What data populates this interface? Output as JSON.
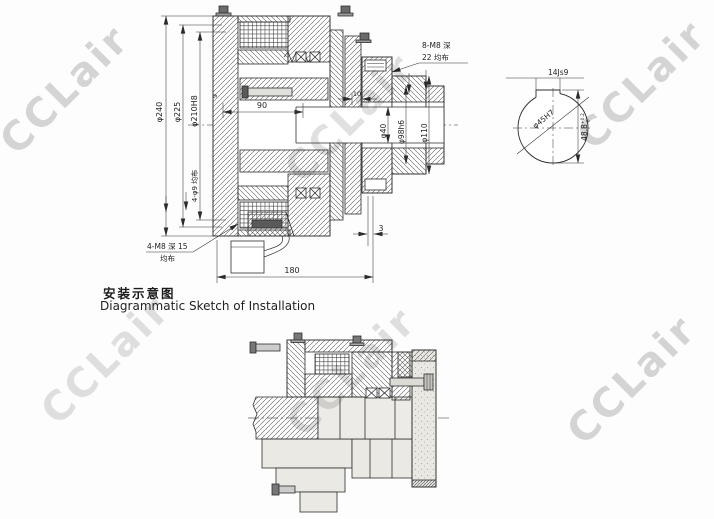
{
  "watermark": {
    "text": "CCLair"
  },
  "titles": {
    "zh": "安装示意图",
    "en": "Diagrammatic Sketch of Installation"
  },
  "section_view": {
    "dia_240": "φ240",
    "dia_225": "φ225",
    "dia_210": "φ210H8",
    "len_90": "90",
    "len_9": "9",
    "len_10": "10",
    "dia_40": "φ40",
    "dia_98": "φ98h6",
    "dia_110": "φ110",
    "gap_3": "3",
    "len_180": "180",
    "note_flange_line1": "8-M8 深",
    "note_flange_line2": "22 均布",
    "note_mount_holes": "4-φ9 均布",
    "note_back_line1": "4-M8 深 15",
    "note_back_line2": "均布"
  },
  "shaft_end_view": {
    "keyway": "14Js9",
    "bore": "φ45H7",
    "height": "48.8",
    "tol_upper": "+0.2",
    "tol_lower": "0"
  }
}
